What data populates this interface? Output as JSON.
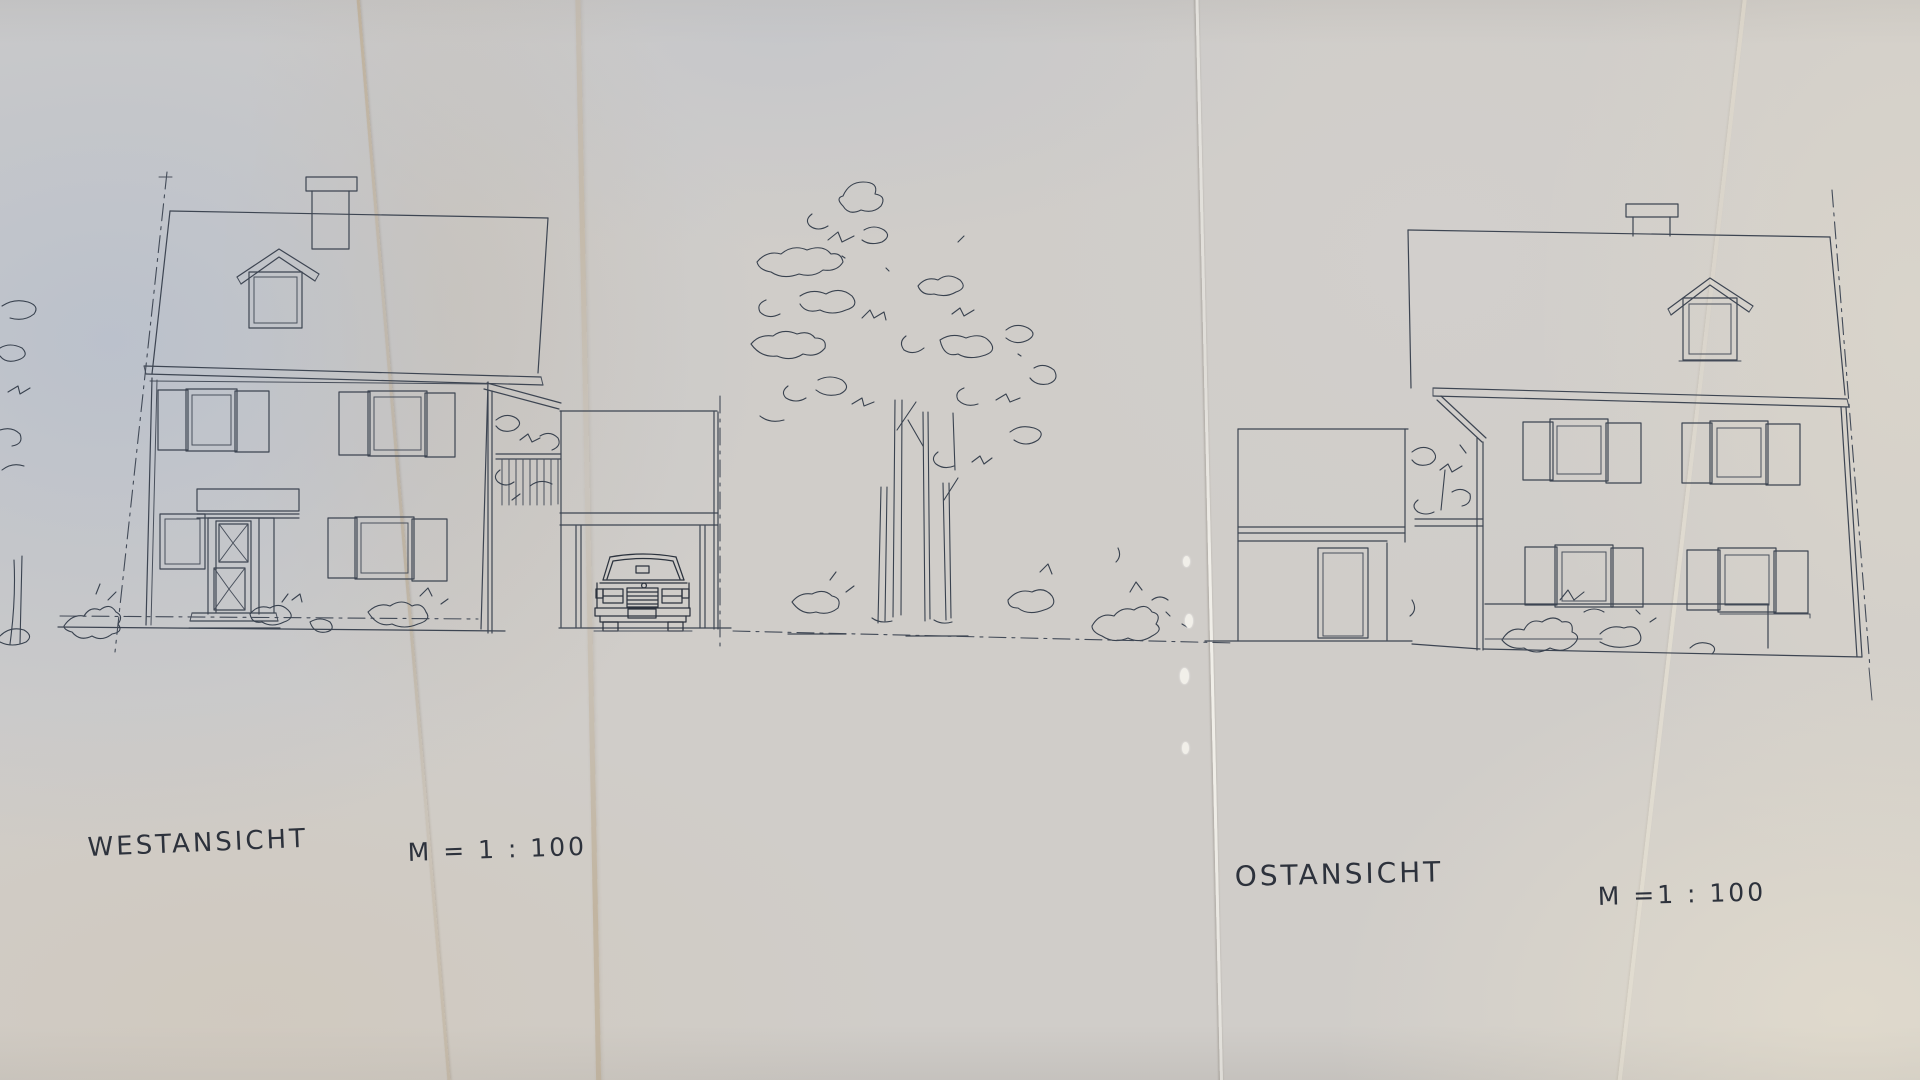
{
  "labels": {
    "west_title": "WESTANSICHT",
    "west_scale": "M = 1 : 100",
    "east_title": "OSTANSICHT",
    "east_scale": "M =1 : 100"
  },
  "drawing": {
    "kind": "hand-drawn architectural elevations on folded paper",
    "views": [
      {
        "name": "west-elevation",
        "title": "WESTANSICHT",
        "scale": "M = 1 : 100"
      },
      {
        "name": "east-elevation",
        "title": "OSTANSICHT",
        "scale": "M =1 : 100"
      }
    ]
  },
  "colors": {
    "ink": "#3d4552",
    "ink_dark": "#2c333e",
    "paper": "#d0cdc9",
    "fold_tan": "#baa380",
    "fold_white": "#f1efe9"
  }
}
